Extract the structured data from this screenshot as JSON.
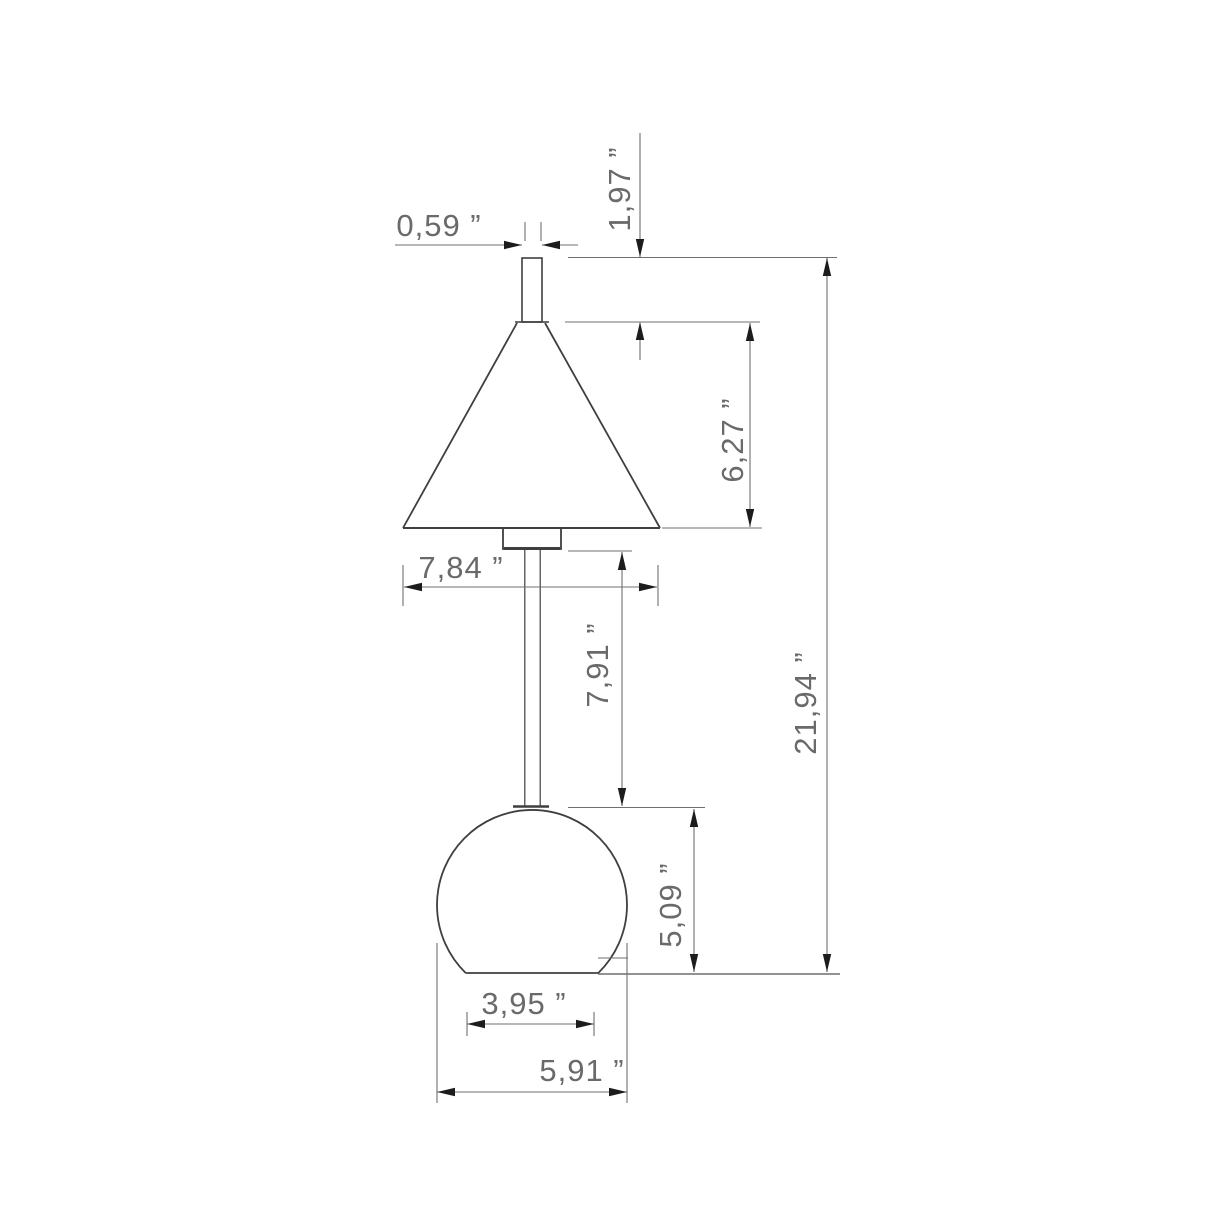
{
  "drawing": {
    "title": "lamp-dimension-drawing",
    "units": "inches",
    "decimal_separator": ",",
    "colors": {
      "object_line": "#3f3f3f",
      "dimension_line": "#6f6f6f",
      "arrowhead": "#1c1c1c",
      "label_text": "#6a6a6a",
      "background": "#ffffff"
    },
    "dimensions": [
      {
        "name": "finial-width",
        "label": "0,59 ”",
        "value": 0.59,
        "orientation": "horizontal"
      },
      {
        "name": "finial-height",
        "label": "1,97 ”",
        "value": 1.97,
        "orientation": "vertical"
      },
      {
        "name": "shade-height",
        "label": "6,27 ”",
        "value": 6.27,
        "orientation": "vertical"
      },
      {
        "name": "shade-diameter",
        "label": "7,84 ”",
        "value": 7.84,
        "orientation": "horizontal"
      },
      {
        "name": "stem-length",
        "label": "7,91 ”",
        "value": 7.91,
        "orientation": "vertical"
      },
      {
        "name": "total-height",
        "label": "21,94 ”",
        "value": 21.94,
        "orientation": "vertical"
      },
      {
        "name": "base-height",
        "label": "5,09 ”",
        "value": 5.09,
        "orientation": "vertical"
      },
      {
        "name": "base-bottom-width",
        "label": "3,95 ”",
        "value": 3.95,
        "orientation": "horizontal"
      },
      {
        "name": "base-width",
        "label": "5,91 ”",
        "value": 5.91,
        "orientation": "horizontal"
      }
    ]
  }
}
